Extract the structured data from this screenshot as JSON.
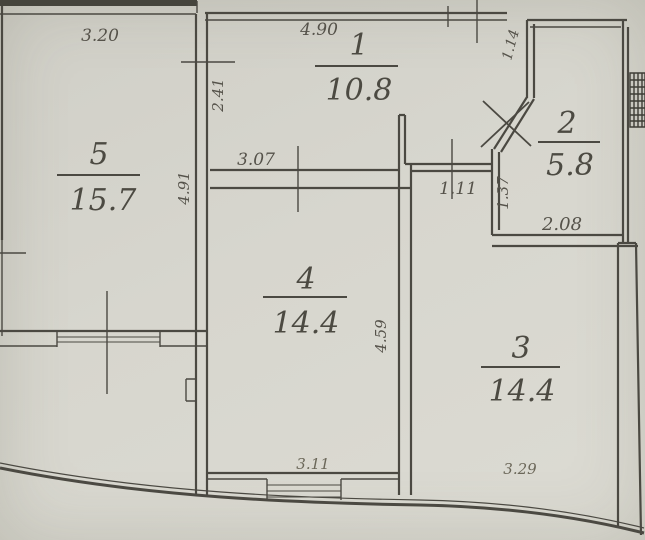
{
  "plan": {
    "type": "apartment floor plan",
    "rooms": [
      {
        "number": "1",
        "area": "10.8"
      },
      {
        "number": "2",
        "area": "5.8"
      },
      {
        "number": "3",
        "area": "14.4"
      },
      {
        "number": "4",
        "area": "14.4"
      },
      {
        "number": "5",
        "area": "15.7"
      }
    ],
    "dims": [
      {
        "value": "3.20"
      },
      {
        "value": "4.90"
      },
      {
        "value": "1.14"
      },
      {
        "value": "2.41"
      },
      {
        "value": "4.91"
      },
      {
        "value": "3.07"
      },
      {
        "value": "1.11"
      },
      {
        "value": "1.37"
      },
      {
        "value": "2.08"
      },
      {
        "value": "4.59"
      },
      {
        "value": "3.11"
      },
      {
        "value": "3.29"
      }
    ],
    "colors": {
      "paper": "#d6d5ce",
      "ink": "#4b4942"
    }
  }
}
